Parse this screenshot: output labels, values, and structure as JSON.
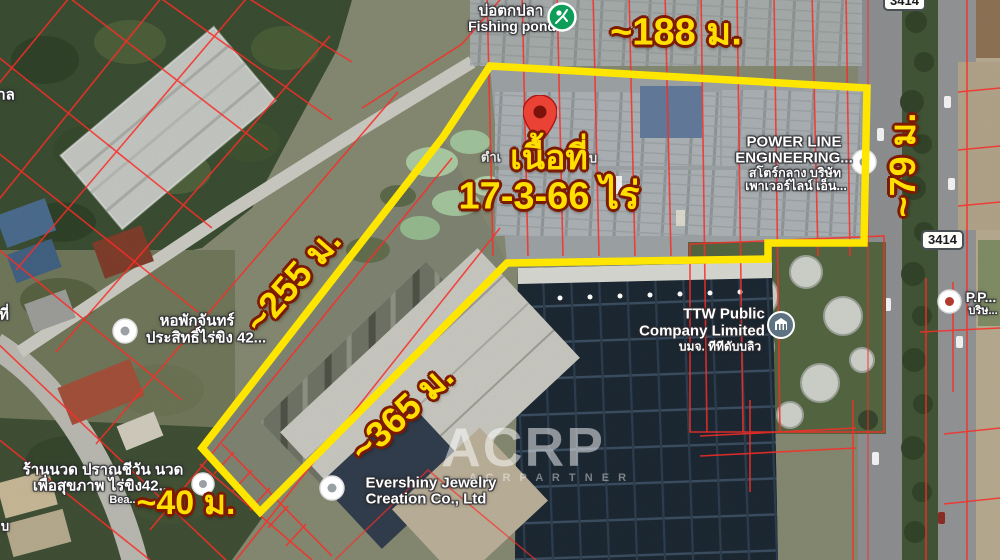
{
  "colors": {
    "boundary": "#ffe600",
    "dimension_text": "#ffdf00",
    "dimension_outline": "#7c1a02",
    "cadastral_line": "#ff2b25",
    "pin": "#ea4335",
    "fishing_icon_green": "#0d9d58",
    "ttw_icon_blue": "#5d7381"
  },
  "boundary": {
    "area_title": "เนื้อที่",
    "area_value": "17-3-66 ไร่",
    "dimensions": {
      "top": "~188 ม.",
      "right": "~79 ม.",
      "upper_left": "~255 ม.",
      "lower_left": "~365 ม.",
      "west_end": "~40 ม."
    }
  },
  "pois": {
    "fishing_pond": {
      "thai": "บ่อตกปลา",
      "en": "Fishing pond"
    },
    "power_line": {
      "name_line1": "POWER LINE",
      "name_line2": "ENGINEERING...",
      "thai_line1": "สโตร์กลาง บริษัท",
      "thai_line2": "เพาเวอร์ไลน์ เอ็น..."
    },
    "ttw": {
      "name_line1": "TTW Public",
      "name_line2": "Company Limited",
      "thai": "บมจ. ทีทีดับบลิว"
    },
    "dormitory": {
      "thai_line1": "หอพักจันทร์",
      "thai_line2": "ประสิทธิ์ไร่ขิง 42..."
    },
    "evershiny": {
      "name_line1": "Evershiny Jewelry",
      "name_line2": "Creation Co., Ltd"
    },
    "massage": {
      "thai_line1": "ร้านนวด ปราณชีวัน นวด",
      "thai_line2": "เพื่อสุขภาพ ไร่ขิง42...",
      "sub": "Bea..."
    },
    "pp": {
      "name": "P.P...",
      "thai": "บริษ..."
    }
  },
  "road_shields": {
    "top": "3414",
    "middle": "3414"
  },
  "map_fragments": {
    "left_upper": "าล",
    "left_middle": "ที่",
    "bottom_left": "บ",
    "behind_area_left": "ตำเ",
    "behind_area_right": "บ"
  },
  "watermark": {
    "logo": "ACRP",
    "tagline": "A C R  P A R T N E R"
  }
}
